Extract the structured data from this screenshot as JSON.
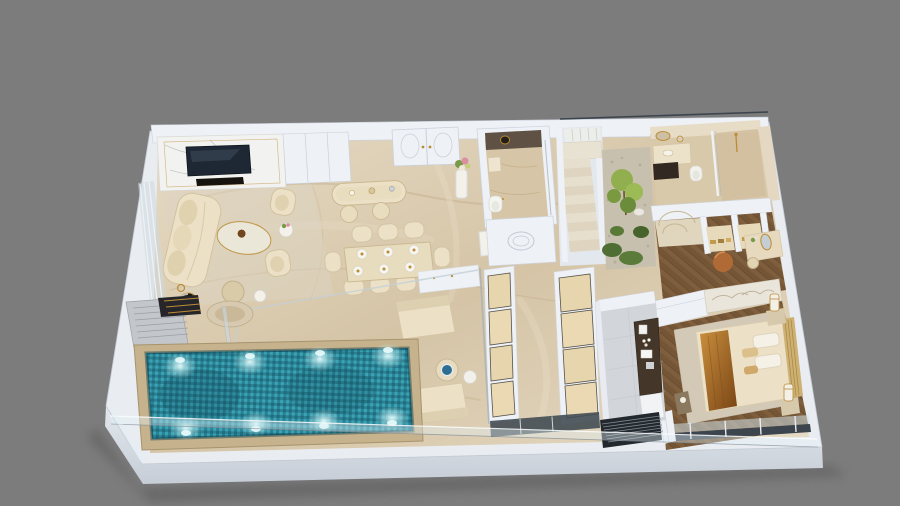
{
  "scene": {
    "kind": "3d-floorplan-render",
    "view": "isometric cutaway, photoreal style",
    "subject": "luxury one-bedroom apartment with private lap pool",
    "canvas": {
      "width": 900,
      "height": 506
    }
  },
  "palette": {
    "bg": "#7c7c7c",
    "slab_top": "#e9edf2",
    "slab_face_light": "#e3e8ee",
    "slab_face_dark": "#c6cdd6",
    "wall": "#eef1f6",
    "wall_shadow": "#c9d0da",
    "marble_light": "#e6dbc5",
    "marble_mid": "#d5c4a6",
    "marble_warm": "#d6c5a6",
    "marble_vein": "#b2946a",
    "wood_dark": "#5e442a",
    "wood_mid": "#745536",
    "wood_light": "#8a6843",
    "pool_deep": "#1f6c7e",
    "pool_mid": "#2a8294",
    "pool_sq": "#3aa4b4",
    "coping": "#c6b28c",
    "glass_frame": "#9fadb7",
    "cream": "#ece1c6",
    "cream_shadow": "#d2c3a1",
    "white_soft": "#f3f1ea",
    "gold": "#bb8c35",
    "amber1": "#c98f3d",
    "amber2": "#7a4516",
    "counter_dark": "#443628",
    "grille": "#23282e",
    "green_dark": "#4f6e33",
    "green_light": "#8fae4b",
    "tv": "#1e2834",
    "track": "#3c444d",
    "gray_floor": "#d2d5d9",
    "towel": "#26262a",
    "pouf": "#b06a35",
    "headboard": "#cdb073",
    "rug": "#dcd3c2"
  },
  "rooms": [
    {
      "id": "living-room",
      "contents": [
        "marble fireplace wall",
        "wall TV",
        "three-seat cream sofa",
        "oval glass coffee table",
        "two cream armchairs",
        "flower side table",
        "round pouf",
        "striped drum table",
        "gold floor lamp",
        "area rug"
      ]
    },
    {
      "id": "dining-area",
      "contents": [
        "marble dining table",
        "eight barrel chairs",
        "six place settings"
      ]
    },
    {
      "id": "bar-island",
      "contents": [
        "oval marble island",
        "two cream stools",
        "decor trays"
      ]
    },
    {
      "id": "powder-room",
      "contents": [
        "dark marble feature wall",
        "round mirror",
        "wall-hung basin",
        "toilet",
        "oval-molding outer wall"
      ]
    },
    {
      "id": "staircase",
      "contents": [
        "upper flight",
        "main flight",
        "white stringers"
      ]
    },
    {
      "id": "courtyard-garden",
      "contents": [
        "pebble bed",
        "shrubs",
        "small tree",
        "white rock"
      ]
    },
    {
      "id": "master-bathroom",
      "contents": [
        "vanity with round gold mirror",
        "dark under-counter",
        "toilet",
        "walk-in shower with gold fixture"
      ]
    },
    {
      "id": "walk-in-closet",
      "contents": [
        "entry marble medallion",
        "three wardrobe bays with folded clothes",
        "orange pouf",
        "dressing table with oval mirror",
        "stool"
      ]
    },
    {
      "id": "bedroom",
      "contents": [
        "double bed",
        "channel headboard",
        "amber throw",
        "white pillows",
        "two nightstands",
        "two column lamps",
        "area rug",
        "etched art panel",
        "foot table",
        "glazed wall with curtain"
      ]
    },
    {
      "id": "kitchenette",
      "contents": [
        "dark L-counter",
        "coffee machine",
        "cup set",
        "towel stack",
        "base cabinet",
        "louvre vent"
      ]
    },
    {
      "id": "corridor-storage",
      "contents": [
        "two champagne wardrobe columns",
        "glazed end door"
      ]
    },
    {
      "id": "outdoor-lounge",
      "contents": [
        "white sideboard",
        "two cushioned loungers",
        "round table with blue dish",
        "white side table",
        "glass screen"
      ]
    },
    {
      "id": "pool-deck",
      "contents": [
        "slatted sun lounger",
        "striped towel",
        "round daybed table",
        "glass door panel"
      ]
    },
    {
      "id": "swimming-pool",
      "contents": [
        "teal mosaic water",
        "stone coping",
        "underwater lights"
      ]
    }
  ],
  "pool": {
    "shape": "rectangular lap pool",
    "finish": "teal mosaic tile",
    "underwater_light_count": 8,
    "lights_per_side": 4
  },
  "structure": {
    "balustrade": "frameless glass along front edge",
    "slab": "white platform with chamfered front-left corner",
    "top_rail": "dark glass rail above bathroom wing"
  }
}
